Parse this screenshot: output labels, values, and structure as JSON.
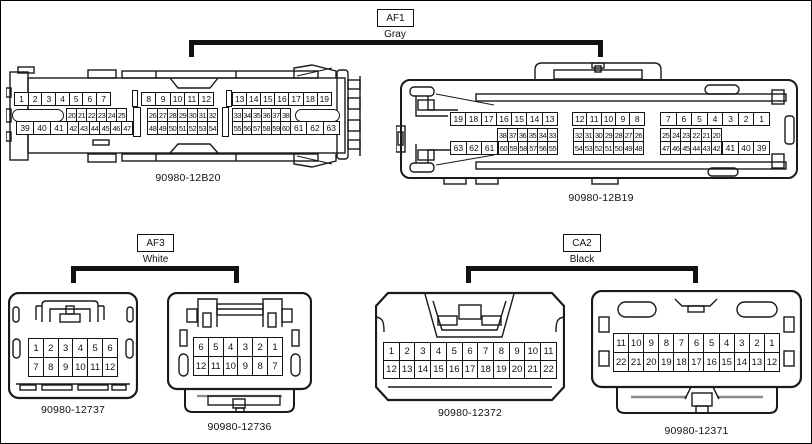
{
  "groups": {
    "af1": {
      "code": "AF1",
      "color": "Gray"
    },
    "af3": {
      "code": "AF3",
      "color": "White"
    },
    "ca2": {
      "code": "CA2",
      "color": "Black"
    }
  },
  "colors": {
    "line": "#1a1a1a",
    "accent_gray": "#8a8a8a"
  },
  "connectors": {
    "b20": {
      "part": "90980-12B20",
      "r1g1": [
        1,
        2,
        3,
        4,
        5,
        6,
        7
      ],
      "r1g2": [
        8,
        9,
        10,
        11,
        12
      ],
      "r1g3": [
        13,
        14,
        15,
        16,
        17,
        18,
        19
      ],
      "r2g1": [
        20,
        21,
        22,
        23,
        24,
        25
      ],
      "r2g2": [
        26,
        27,
        28,
        29,
        30,
        31,
        32
      ],
      "r2g3": [
        33,
        34,
        35,
        36,
        37,
        38
      ],
      "r3g1a": [
        39,
        40,
        41
      ],
      "r3g1b": [
        42,
        43,
        44,
        45,
        46,
        47
      ],
      "r3g2": [
        48,
        49,
        50,
        51,
        52,
        53,
        54
      ],
      "r3g3a": [
        55,
        56,
        57,
        58,
        59,
        60
      ],
      "r3g3b": [
        61,
        62,
        63
      ]
    },
    "b19": {
      "part": "90980-12B19",
      "r1g1": [
        19,
        18,
        17,
        16,
        15,
        14,
        13
      ],
      "r1g2": [
        12,
        11,
        10,
        9,
        8
      ],
      "r1g3": [
        7,
        6,
        5,
        4,
        3,
        2,
        1
      ],
      "r2g1": [
        38,
        37,
        36,
        35,
        34,
        33
      ],
      "r2g2": [
        32,
        31,
        30,
        29,
        28,
        27,
        26
      ],
      "r2g3": [
        25,
        24,
        23,
        22,
        21,
        20
      ],
      "r3g1a": [
        63,
        62,
        61
      ],
      "r3g1b": [
        60,
        59,
        58,
        57,
        56,
        55
      ],
      "r3g2": [
        54,
        53,
        52,
        51,
        50,
        49,
        48
      ],
      "r3g3a": [
        47,
        46,
        45,
        44,
        43,
        42
      ],
      "r3g3b": [
        41,
        40,
        39
      ]
    },
    "c12737": {
      "part": "90980-12737",
      "r1": [
        1,
        2,
        3,
        4,
        5,
        6
      ],
      "r2": [
        7,
        8,
        9,
        10,
        11,
        12
      ]
    },
    "c12736": {
      "part": "90980-12736",
      "r1": [
        6,
        5,
        4,
        3,
        2,
        1
      ],
      "r2": [
        12,
        11,
        10,
        9,
        8,
        7
      ]
    },
    "c12372": {
      "part": "90980-12372",
      "r1": [
        1,
        2,
        3,
        4,
        5,
        6,
        7,
        8,
        9,
        10,
        11
      ],
      "r2": [
        12,
        13,
        14,
        15,
        16,
        17,
        18,
        19,
        20,
        21,
        22
      ]
    },
    "c12371": {
      "part": "90980-12371",
      "r1": [
        11,
        10,
        9,
        8,
        7,
        6,
        5,
        4,
        3,
        2,
        1
      ],
      "r2": [
        22,
        21,
        20,
        19,
        18,
        17,
        16,
        15,
        14,
        13,
        12
      ]
    }
  }
}
